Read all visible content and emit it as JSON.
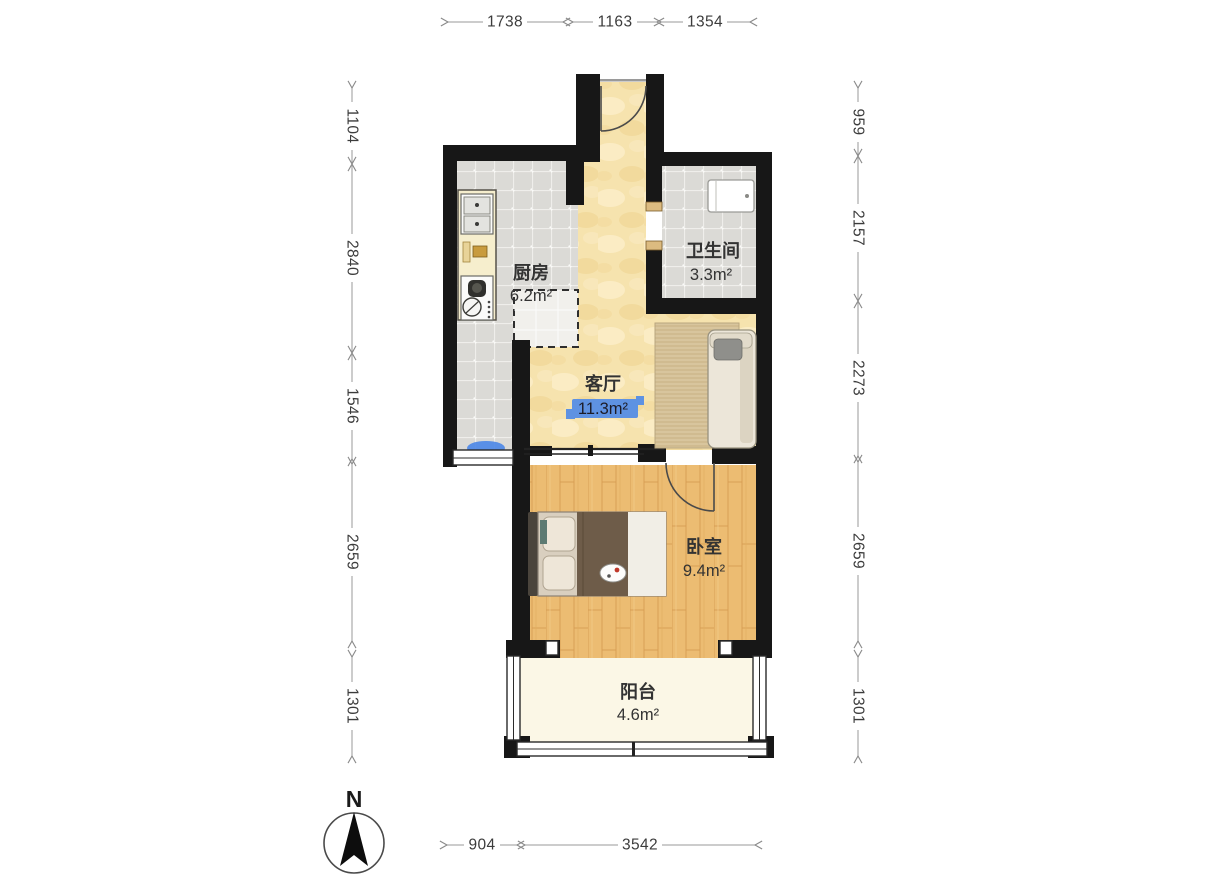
{
  "rooms": {
    "kitchen": {
      "name": "厨房",
      "area": "6.2m²"
    },
    "bathroom": {
      "name": "卫生间",
      "area": "3.3m²"
    },
    "living": {
      "name": "客厅",
      "area": "11.3m²"
    },
    "bedroom": {
      "name": "卧室",
      "area": "9.4m²"
    },
    "balcony": {
      "name": "阳台",
      "area": "4.6m²"
    }
  },
  "dims": {
    "top": [
      "1738",
      "1163",
      "1354"
    ],
    "left": [
      "1104",
      "2840",
      "1546",
      "2659",
      "1301"
    ],
    "right": [
      "959",
      "2157",
      "2273",
      "2659",
      "1301"
    ],
    "bottom": [
      "904",
      "3542"
    ]
  },
  "compass": {
    "north_label": "N"
  },
  "colors": {
    "wall": "#171717",
    "selection_highlight": "#5e92e2",
    "window_glass_accent": "#4a86e8",
    "wood_floor": "#ecbc72",
    "tile_floor": "#dbdad6",
    "warm_floor": "#f6e3ae",
    "balcony_floor": "#fbf7e6"
  }
}
